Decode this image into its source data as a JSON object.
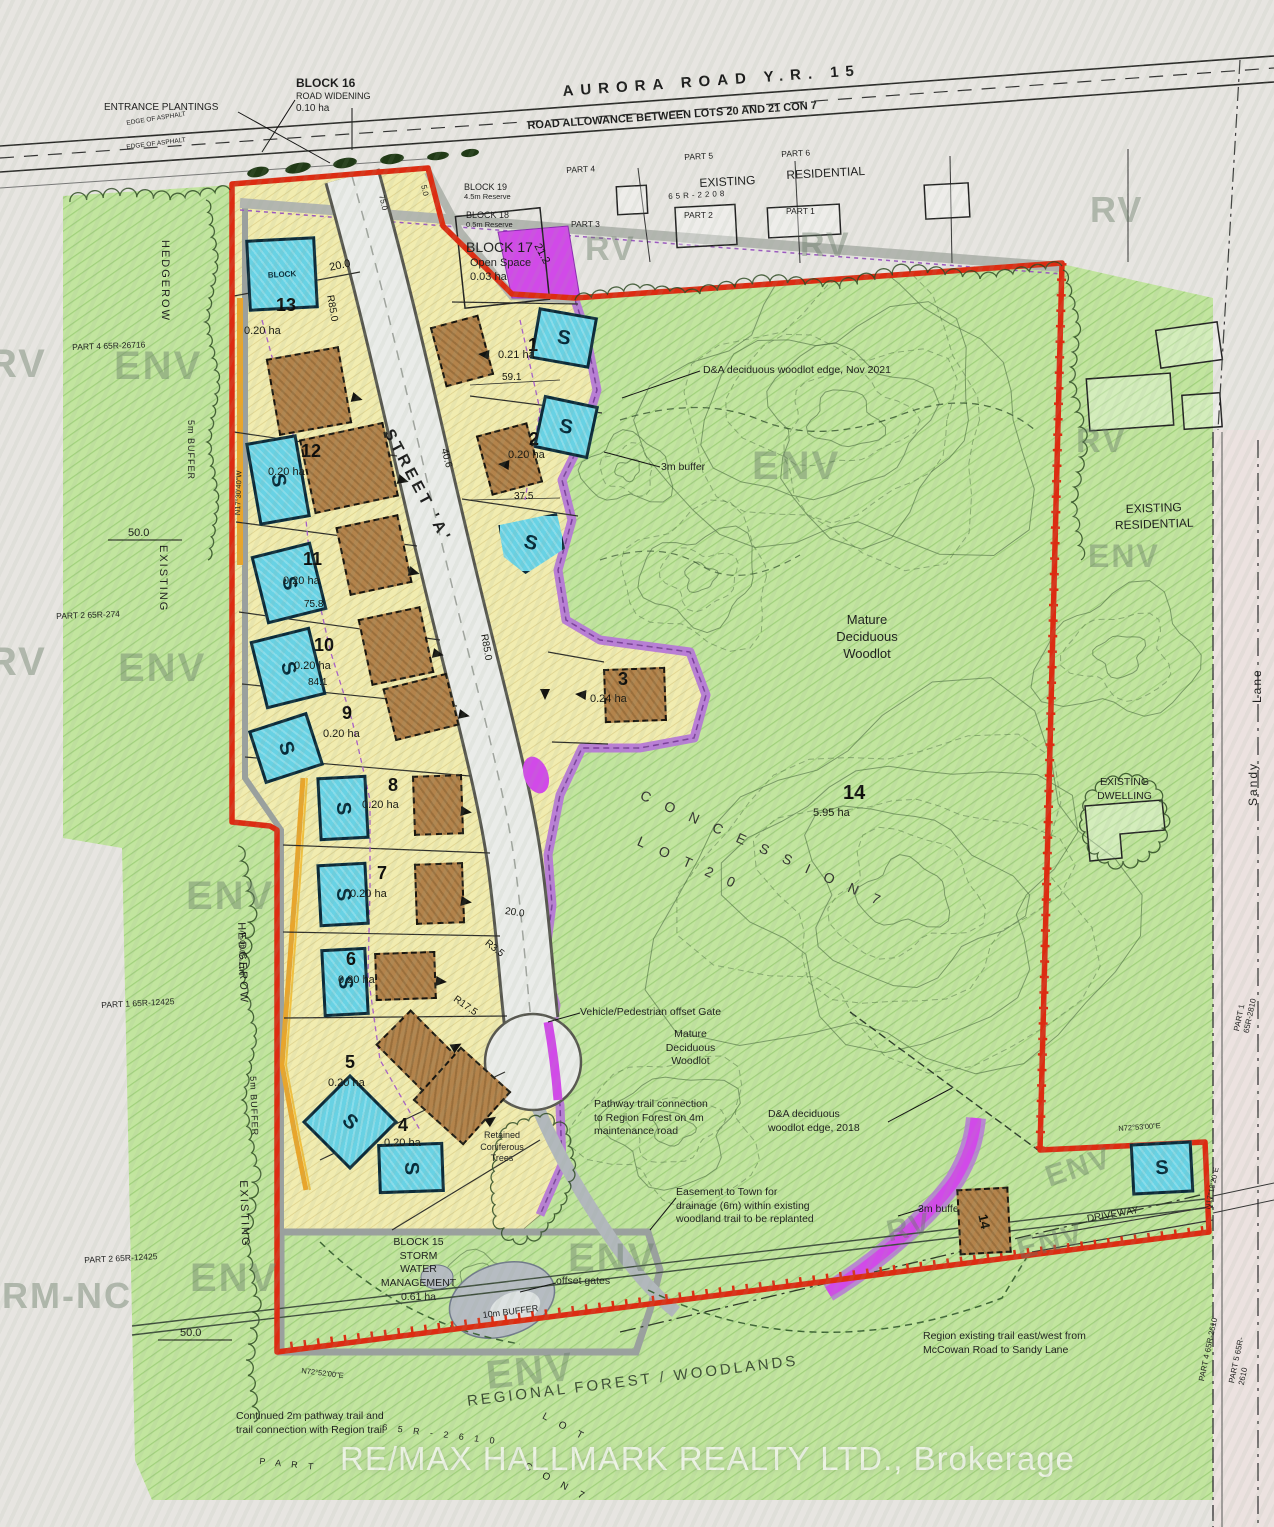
{
  "watermark": {
    "brokerage": "RE/MAX HALLMARK REALTY LTD., Brokerage"
  },
  "colors": {
    "boundary_red": "#dc2c12",
    "buffer_purple": "#b678d8",
    "magenta": "#d14ae8",
    "septic_cyan": "#68d2e4",
    "envelope_brown": "#b3834b",
    "parcel_yellow": "#f1ecb0",
    "forest_green": "#c2e59f",
    "orange_buffer": "#e8a52c"
  },
  "annotations": [
    {
      "t": "ENTRANCE PLANTINGS",
      "x": 104,
      "y": 101,
      "fs": 10
    },
    {
      "t": "BLOCK 16",
      "x": 296,
      "y": 76,
      "fs": 12,
      "b": 1
    },
    {
      "t": "ROAD WIDENING",
      "x": 296,
      "y": 91,
      "fs": 9
    },
    {
      "t": "0.10 ha",
      "x": 296,
      "y": 102,
      "fs": 10
    },
    {
      "t": "AURORA ROAD Y.R. 15",
      "x": 562,
      "y": 82,
      "fs": 15,
      "rot": -4,
      "ls": 7,
      "b": 1
    },
    {
      "t": "ROAD ALLOWANCE BETWEEN LOTS 20 AND 21 CON 7",
      "x": 527,
      "y": 119,
      "fs": 11,
      "rot": -4,
      "b": 1
    },
    {
      "t": "PART 4",
      "x": 566,
      "y": 165,
      "fs": 8.5,
      "rot": -3
    },
    {
      "t": "PART 5",
      "x": 684,
      "y": 152,
      "fs": 8.5,
      "rot": -3
    },
    {
      "t": "PART 6",
      "x": 781,
      "y": 149,
      "fs": 8.5,
      "rot": -3
    },
    {
      "t": "EXISTING",
      "x": 699,
      "y": 176,
      "fs": 12,
      "rot": -3
    },
    {
      "t": "RESIDENTIAL",
      "x": 786,
      "y": 168,
      "fs": 12,
      "rot": -3
    },
    {
      "t": "65R-2208",
      "x": 668,
      "y": 192,
      "fs": 8,
      "ls": 3,
      "rot": -3
    },
    {
      "t": "PART 3",
      "x": 571,
      "y": 219,
      "fs": 8.5
    },
    {
      "t": "PART 2",
      "x": 684,
      "y": 210,
      "fs": 8.5
    },
    {
      "t": "PART 1",
      "x": 786,
      "y": 206,
      "fs": 8.5
    },
    {
      "t": "BLOCK 19",
      "x": 464,
      "y": 182,
      "fs": 9
    },
    {
      "t": "4.5m Reserve",
      "x": 464,
      "y": 192,
      "fs": 7.5
    },
    {
      "t": "BLOCK 18",
      "x": 466,
      "y": 210,
      "fs": 9
    },
    {
      "t": "0.5m Reserve",
      "x": 466,
      "y": 220,
      "fs": 7.5
    },
    {
      "t": "BLOCK 17",
      "x": 466,
      "y": 238,
      "fs": 14
    },
    {
      "t": "Open Space\n0.03 ha",
      "x": 470,
      "y": 256,
      "fs": 11
    },
    {
      "t": "D&A deciduous woodlot edge, Nov 2021",
      "x": 703,
      "y": 364,
      "fs": 10.5
    },
    {
      "t": "3m buffer",
      "x": 661,
      "y": 461,
      "fs": 10.5
    },
    {
      "t": "Mature\nDeciduous\nWoodlot",
      "x": 812,
      "y": 612,
      "fs": 13,
      "w": 110,
      "ta": "center"
    },
    {
      "t": "Vehicle/Pedestrian offset Gate",
      "x": 580,
      "y": 1006,
      "fs": 10.5
    },
    {
      "t": "Mature\nDeciduous\nWoodlot",
      "x": 643,
      "y": 1028,
      "fs": 10.5,
      "w": 95,
      "ta": "center"
    },
    {
      "t": "Pathway trail connection\nto Region Forest on 4m\nmaintenance road",
      "x": 594,
      "y": 1098,
      "fs": 10.5
    },
    {
      "t": "D&A deciduous\nwoodlot edge, 2018",
      "x": 768,
      "y": 1108,
      "fs": 10.5
    },
    {
      "t": "Easement to Town for\ndrainage (6m) within existing\nwoodland trail to be replanted",
      "x": 676,
      "y": 1186,
      "fs": 10.5
    },
    {
      "t": "3m buffer",
      "x": 918,
      "y": 1203,
      "fs": 10.5
    },
    {
      "t": "BLOCK 15\nSTORM\nWATER\nMANAGEMENT\n0.61 ha",
      "x": 366,
      "y": 1236,
      "fs": 10.5,
      "w": 105,
      "ta": "center"
    },
    {
      "t": "offset gates",
      "x": 556,
      "y": 1275,
      "fs": 10.5
    },
    {
      "t": "10m BUFFER",
      "x": 482,
      "y": 1310,
      "fs": 9,
      "rot": -7
    },
    {
      "t": "Region existing trail east/west from\nMcCowan Road to Sandy Lane",
      "x": 923,
      "y": 1330,
      "fs": 10.5
    },
    {
      "t": "Continued 2m pathway trail and\ntrail connection with Region trail",
      "x": 236,
      "y": 1410,
      "fs": 10.5
    },
    {
      "t": "REGIONAL   FOREST   /   WOODLANDS",
      "x": 466,
      "y": 1392,
      "fs": 15,
      "rot": -7,
      "ls": 3,
      "c": "#3c4c34"
    },
    {
      "t": "EXISTING\nRESIDENTIAL",
      "x": 1096,
      "y": 503,
      "fs": 12,
      "w": 115,
      "ta": "center",
      "rot": -2
    },
    {
      "t": "EXISTING\nDWELLING",
      "x": 1082,
      "y": 776,
      "fs": 10.5,
      "w": 85,
      "ta": "center"
    },
    {
      "t": "Sandy",
      "x": 1246,
      "y": 806,
      "fs": 12,
      "rot": -90,
      "ls": 2
    },
    {
      "t": "Lane",
      "x": 1250,
      "y": 703,
      "fs": 12,
      "rot": -90,
      "ls": 2
    },
    {
      "t": "DRIVEWAY",
      "x": 1086,
      "y": 1213,
      "fs": 10,
      "rot": -10
    },
    {
      "t": "Retained\nConiferous\nTrees",
      "x": 470,
      "y": 1130,
      "fs": 9,
      "w": 64,
      "ta": "center"
    },
    {
      "t": "PART 4  65R-26716",
      "x": 72,
      "y": 342,
      "fs": 8.5,
      "rot": -2
    },
    {
      "t": "PART 2  65R-274",
      "x": 56,
      "y": 611,
      "fs": 8.5,
      "rot": -2
    },
    {
      "t": "PART 1  65R-12425",
      "x": 101,
      "y": 1000,
      "fs": 8.5,
      "rot": -3
    },
    {
      "t": "PART 2  65R-12425",
      "x": 84,
      "y": 1255,
      "fs": 8.5,
      "rot": -3
    },
    {
      "t": "HEDGEROW",
      "x": 172,
      "y": 240,
      "fs": 11,
      "rot": 90,
      "ls": 2
    },
    {
      "t": "5m BUFFER",
      "x": 196,
      "y": 420,
      "fs": 9,
      "rot": 90,
      "ls": 1
    },
    {
      "t": "EXISTING",
      "x": 170,
      "y": 545,
      "fs": 11,
      "rot": 90,
      "ls": 2
    },
    {
      "t": "50.0",
      "x": 128,
      "y": 526,
      "fs": 11
    },
    {
      "t": "HEDGEROW",
      "x": 248,
      "y": 922,
      "fs": 11,
      "rot": 88,
      "ls": 2
    },
    {
      "t": "5m BUFFER",
      "x": 258,
      "y": 1076,
      "fs": 9,
      "rot": 88,
      "ls": 1
    },
    {
      "t": "EXISTING",
      "x": 250,
      "y": 1180,
      "fs": 11,
      "rot": 88,
      "ls": 2
    },
    {
      "t": "50.0",
      "x": 180,
      "y": 1326,
      "fs": 11
    },
    {
      "t": "PART 1  65R-2810",
      "x": 1232,
      "y": 1030,
      "fs": 8,
      "rot": -78
    },
    {
      "t": "PART 4  65R-2610",
      "x": 1197,
      "y": 1380,
      "fs": 8,
      "rot": -78
    },
    {
      "t": "PART 5  65R-2610",
      "x": 1227,
      "y": 1382,
      "fs": 8,
      "rot": -78
    },
    {
      "t": "N72°53'00\"E",
      "x": 1118,
      "y": 1124,
      "fs": 7.5,
      "rot": -4
    },
    {
      "t": "N17°18'20\"E",
      "x": 1203,
      "y": 1208,
      "fs": 7.5,
      "rot": -78
    },
    {
      "t": "N72°52'00\"E",
      "x": 302,
      "y": 1366,
      "fs": 7.5,
      "rot": 7
    },
    {
      "t": "N17°30'40\"W",
      "x": 233,
      "y": 515,
      "fs": 7.5,
      "rot": -88
    },
    {
      "t": "N17°30'40\"W",
      "x": 237,
      "y": 975,
      "fs": 7.5,
      "rot": -88
    },
    {
      "t": "C O N C E S S I O N   7",
      "x": 645,
      "y": 786,
      "fs": 14,
      "rot": 24,
      "ls": 6,
      "c": "#333330"
    },
    {
      "t": "L O T   2 0",
      "x": 642,
      "y": 832,
      "fs": 14,
      "rot": 24,
      "ls": 6,
      "c": "#333330"
    },
    {
      "t": "P A R T",
      "x": 260,
      "y": 1456,
      "fs": 9,
      "rot": 6,
      "ls": 4
    },
    {
      "t": "6 5 R - 2 6 1 0",
      "x": 383,
      "y": 1422,
      "fs": 9,
      "rot": 7,
      "ls": 4
    },
    {
      "t": "L O T",
      "x": 546,
      "y": 1410,
      "fs": 10,
      "rot": 28,
      "ls": 5
    },
    {
      "t": "C O N   7",
      "x": 528,
      "y": 1460,
      "fs": 10,
      "rot": 28,
      "ls": 5
    },
    {
      "t": "STREET 'A'",
      "x": 396,
      "y": 426,
      "fs": 16,
      "rot": 62,
      "ls": 4,
      "b": 1
    },
    {
      "t": "EDGE OF ASPHALT",
      "x": 126,
      "y": 120,
      "fs": 6.5,
      "rot": -9
    },
    {
      "t": "EDGE OF ASPHALT",
      "x": 126,
      "y": 144,
      "fs": 6.5,
      "rot": -7
    }
  ],
  "dims": [
    {
      "t": "20.0",
      "x": 328,
      "y": 261,
      "rot": -12,
      "fs": 11
    },
    {
      "t": "21.2",
      "x": 543,
      "y": 241,
      "rot": 62,
      "fs": 11
    },
    {
      "t": "R85.0",
      "x": 336,
      "y": 294,
      "rot": 80
    },
    {
      "t": "R85.0",
      "x": 490,
      "y": 633,
      "rot": 80
    },
    {
      "t": "59.1",
      "x": 502,
      "y": 371
    },
    {
      "t": "37.5",
      "x": 514,
      "y": 490
    },
    {
      "t": "40.6",
      "x": 450,
      "y": 447,
      "rot": 75
    },
    {
      "t": "75.8",
      "x": 304,
      "y": 598
    },
    {
      "t": "84.1",
      "x": 308,
      "y": 676
    },
    {
      "t": "20.0",
      "x": 506,
      "y": 905,
      "rot": 8
    },
    {
      "t": "R3.5",
      "x": 490,
      "y": 937,
      "rot": 38
    },
    {
      "t": "R17.5",
      "x": 458,
      "y": 993,
      "rot": 35
    },
    {
      "t": "75.0",
      "x": 386,
      "y": 194,
      "rot": 78,
      "fs": 8
    },
    {
      "t": "5.0",
      "x": 428,
      "y": 184,
      "rot": 78,
      "fs": 8
    }
  ],
  "zone_watermarks": [
    {
      "t": "ENV",
      "x": 114,
      "y": 346
    },
    {
      "t": "RV",
      "x": -12,
      "y": 344
    },
    {
      "t": "ENV",
      "x": 118,
      "y": 648
    },
    {
      "t": "RV",
      "x": -12,
      "y": 642
    },
    {
      "t": "ENV",
      "x": 186,
      "y": 876
    },
    {
      "t": "ENV",
      "x": 190,
      "y": 1258
    },
    {
      "t": "ENV",
      "x": 752,
      "y": 446
    },
    {
      "t": "ENV",
      "x": 1088,
      "y": 540,
      "fs": 32
    },
    {
      "t": "ENV",
      "x": 568,
      "y": 1238
    },
    {
      "t": "ENV",
      "x": 484,
      "y": 1356,
      "rot": -6
    },
    {
      "t": "ENV",
      "x": 1042,
      "y": 1164,
      "rot": -18,
      "fs": 30
    },
    {
      "t": "ENV",
      "x": 1014,
      "y": 1236,
      "rot": -14,
      "fs": 30
    },
    {
      "t": "RV",
      "x": 585,
      "y": 232,
      "fs": 34
    },
    {
      "t": "RV",
      "x": 800,
      "y": 228,
      "fs": 34
    },
    {
      "t": "RV",
      "x": 1090,
      "y": 192,
      "fs": 36
    },
    {
      "t": "RV",
      "x": 1076,
      "y": 424,
      "fs": 34
    },
    {
      "t": "RV",
      "x": 884,
      "y": 1218,
      "rot": -12,
      "fs": 30
    },
    {
      "t": "RM-NC",
      "x": 2,
      "y": 1278,
      "fs": 36
    }
  ],
  "lots": [
    {
      "n": "13",
      "nx": 276,
      "ny": 294,
      "a": "0.20 ha",
      "ax": 244,
      "ay": 324
    },
    {
      "n": "12",
      "nx": 301,
      "ny": 440,
      "a": "0.20 ha",
      "ax": 268,
      "ay": 465
    },
    {
      "n": "11",
      "nx": 303,
      "ny": 548,
      "a": "0.20 ha",
      "ax": 283,
      "ay": 574
    },
    {
      "n": "10",
      "nx": 314,
      "ny": 634,
      "a": "0.20 ha",
      "ax": 294,
      "ay": 659
    },
    {
      "n": "9",
      "nx": 342,
      "ny": 702,
      "a": "0.20 ha",
      "ax": 323,
      "ay": 727
    },
    {
      "n": "8",
      "nx": 388,
      "ny": 774,
      "a": "0.20 ha",
      "ax": 362,
      "ay": 798
    },
    {
      "n": "7",
      "nx": 377,
      "ny": 862,
      "a": "0.20 ha",
      "ax": 350,
      "ay": 887
    },
    {
      "n": "6",
      "nx": 346,
      "ny": 948,
      "a": "0.20 ha",
      "ax": 338,
      "ay": 973
    },
    {
      "n": "5",
      "nx": 345,
      "ny": 1051,
      "a": "0.20 ha",
      "ax": 328,
      "ay": 1076
    },
    {
      "n": "4",
      "nx": 398,
      "ny": 1114,
      "a": "0.20 ha",
      "ax": 384,
      "ay": 1136
    },
    {
      "n": "1",
      "nx": 528,
      "ny": 334,
      "a": "0.21 ha",
      "ax": 498,
      "ay": 348
    },
    {
      "n": "2",
      "nx": 529,
      "ny": 428,
      "a": "0.20 ha",
      "ax": 508,
      "ay": 448
    },
    {
      "n": "3",
      "nx": 618,
      "ny": 668,
      "a": "0.24 ha",
      "ax": 590,
      "ay": 692
    },
    {
      "n": "14",
      "nx": 843,
      "ny": 780,
      "a": "5.95 ha",
      "ax": 813,
      "ay": 806
    }
  ],
  "s_boxes": [
    {
      "x": 247,
      "y": 238,
      "w": 64,
      "h": 66,
      "rot": -3,
      "l": "BLOCK",
      "lr": 0,
      "fs": 8
    },
    {
      "x": 252,
      "y": 438,
      "w": 46,
      "h": 78,
      "rot": -10,
      "l": "S",
      "lr": 90
    },
    {
      "x": 258,
      "y": 548,
      "w": 56,
      "h": 64,
      "rot": -14,
      "l": "S",
      "lr": 90
    },
    {
      "x": 257,
      "y": 633,
      "w": 56,
      "h": 64,
      "rot": -14,
      "l": "S",
      "lr": 90
    },
    {
      "x": 255,
      "y": 720,
      "w": 56,
      "h": 50,
      "rot": -18,
      "l": "S",
      "lr": 90
    },
    {
      "x": 318,
      "y": 776,
      "w": 44,
      "h": 58,
      "rot": -3,
      "l": "S",
      "lr": 90
    },
    {
      "x": 318,
      "y": 863,
      "w": 44,
      "h": 57,
      "rot": -3,
      "l": "S",
      "lr": 90
    },
    {
      "x": 322,
      "y": 948,
      "w": 40,
      "h": 62,
      "rot": -3,
      "l": "S",
      "lr": 90
    },
    {
      "x": 316,
      "y": 1088,
      "w": 62,
      "h": 62,
      "rot": 45,
      "l": "S",
      "lr": 0
    },
    {
      "x": 378,
      "y": 1143,
      "w": 60,
      "h": 44,
      "rot": -2,
      "l": "S",
      "lr": 90
    },
    {
      "x": 534,
      "y": 312,
      "w": 54,
      "h": 46,
      "rot": 10,
      "l": "S",
      "lr": 0
    },
    {
      "x": 538,
      "y": 400,
      "w": 50,
      "h": 48,
      "rot": 12,
      "l": "S",
      "lr": 0
    },
    {
      "x": 497,
      "y": 513,
      "w": 62,
      "h": 55,
      "rot": 0,
      "l": "S",
      "lr": 15,
      "clip": 1
    },
    {
      "x": 1131,
      "y": 1142,
      "w": 56,
      "h": 46,
      "rot": -3,
      "l": "S",
      "lr": 0
    }
  ],
  "brown_boxes": [
    {
      "x": 272,
      "y": 352,
      "w": 70,
      "h": 74,
      "rot": -10
    },
    {
      "x": 306,
      "y": 430,
      "w": 82,
      "h": 72,
      "rot": -12
    },
    {
      "x": 342,
      "y": 520,
      "w": 60,
      "h": 66,
      "rot": -12
    },
    {
      "x": 364,
      "y": 612,
      "w": 60,
      "h": 64,
      "rot": -12
    },
    {
      "x": 388,
      "y": 680,
      "w": 62,
      "h": 50,
      "rot": -14
    },
    {
      "x": 413,
      "y": 775,
      "w": 46,
      "h": 56,
      "rot": -2
    },
    {
      "x": 415,
      "y": 863,
      "w": 45,
      "h": 57,
      "rot": -2
    },
    {
      "x": 375,
      "y": 952,
      "w": 57,
      "h": 44,
      "rot": -2
    },
    {
      "x": 383,
      "y": 1026,
      "w": 64,
      "h": 46,
      "rot": 45
    },
    {
      "x": 428,
      "y": 1060,
      "w": 64,
      "h": 68,
      "rot": 42
    },
    {
      "x": 437,
      "y": 320,
      "w": 46,
      "h": 58,
      "rot": -15
    },
    {
      "x": 483,
      "y": 428,
      "w": 49,
      "h": 58,
      "rot": -15
    },
    {
      "x": 604,
      "y": 668,
      "w": 58,
      "h": 50,
      "rot": -2
    },
    {
      "x": 958,
      "y": 1188,
      "w": 48,
      "h": 62,
      "rot": -3,
      "l": "14",
      "lr": 80
    }
  ],
  "arrows": [
    {
      "x": 352,
      "y": 392,
      "r": 15
    },
    {
      "x": 398,
      "y": 474,
      "r": 15
    },
    {
      "x": 409,
      "y": 566,
      "r": 15
    },
    {
      "x": 433,
      "y": 648,
      "r": 12
    },
    {
      "x": 459,
      "y": 709,
      "r": 12
    },
    {
      "x": 461,
      "y": 806,
      "r": 8
    },
    {
      "x": 461,
      "y": 896,
      "r": 8
    },
    {
      "x": 436,
      "y": 976,
      "r": 5
    },
    {
      "x": 452,
      "y": 1044,
      "r": -30
    },
    {
      "x": 487,
      "y": 1118,
      "r": -35
    },
    {
      "x": 489,
      "y": 350,
      "r": 185
    },
    {
      "x": 509,
      "y": 460,
      "r": 185
    },
    {
      "x": 586,
      "y": 690,
      "r": 185
    },
    {
      "x": 545,
      "y": 684,
      "r": 90
    }
  ]
}
